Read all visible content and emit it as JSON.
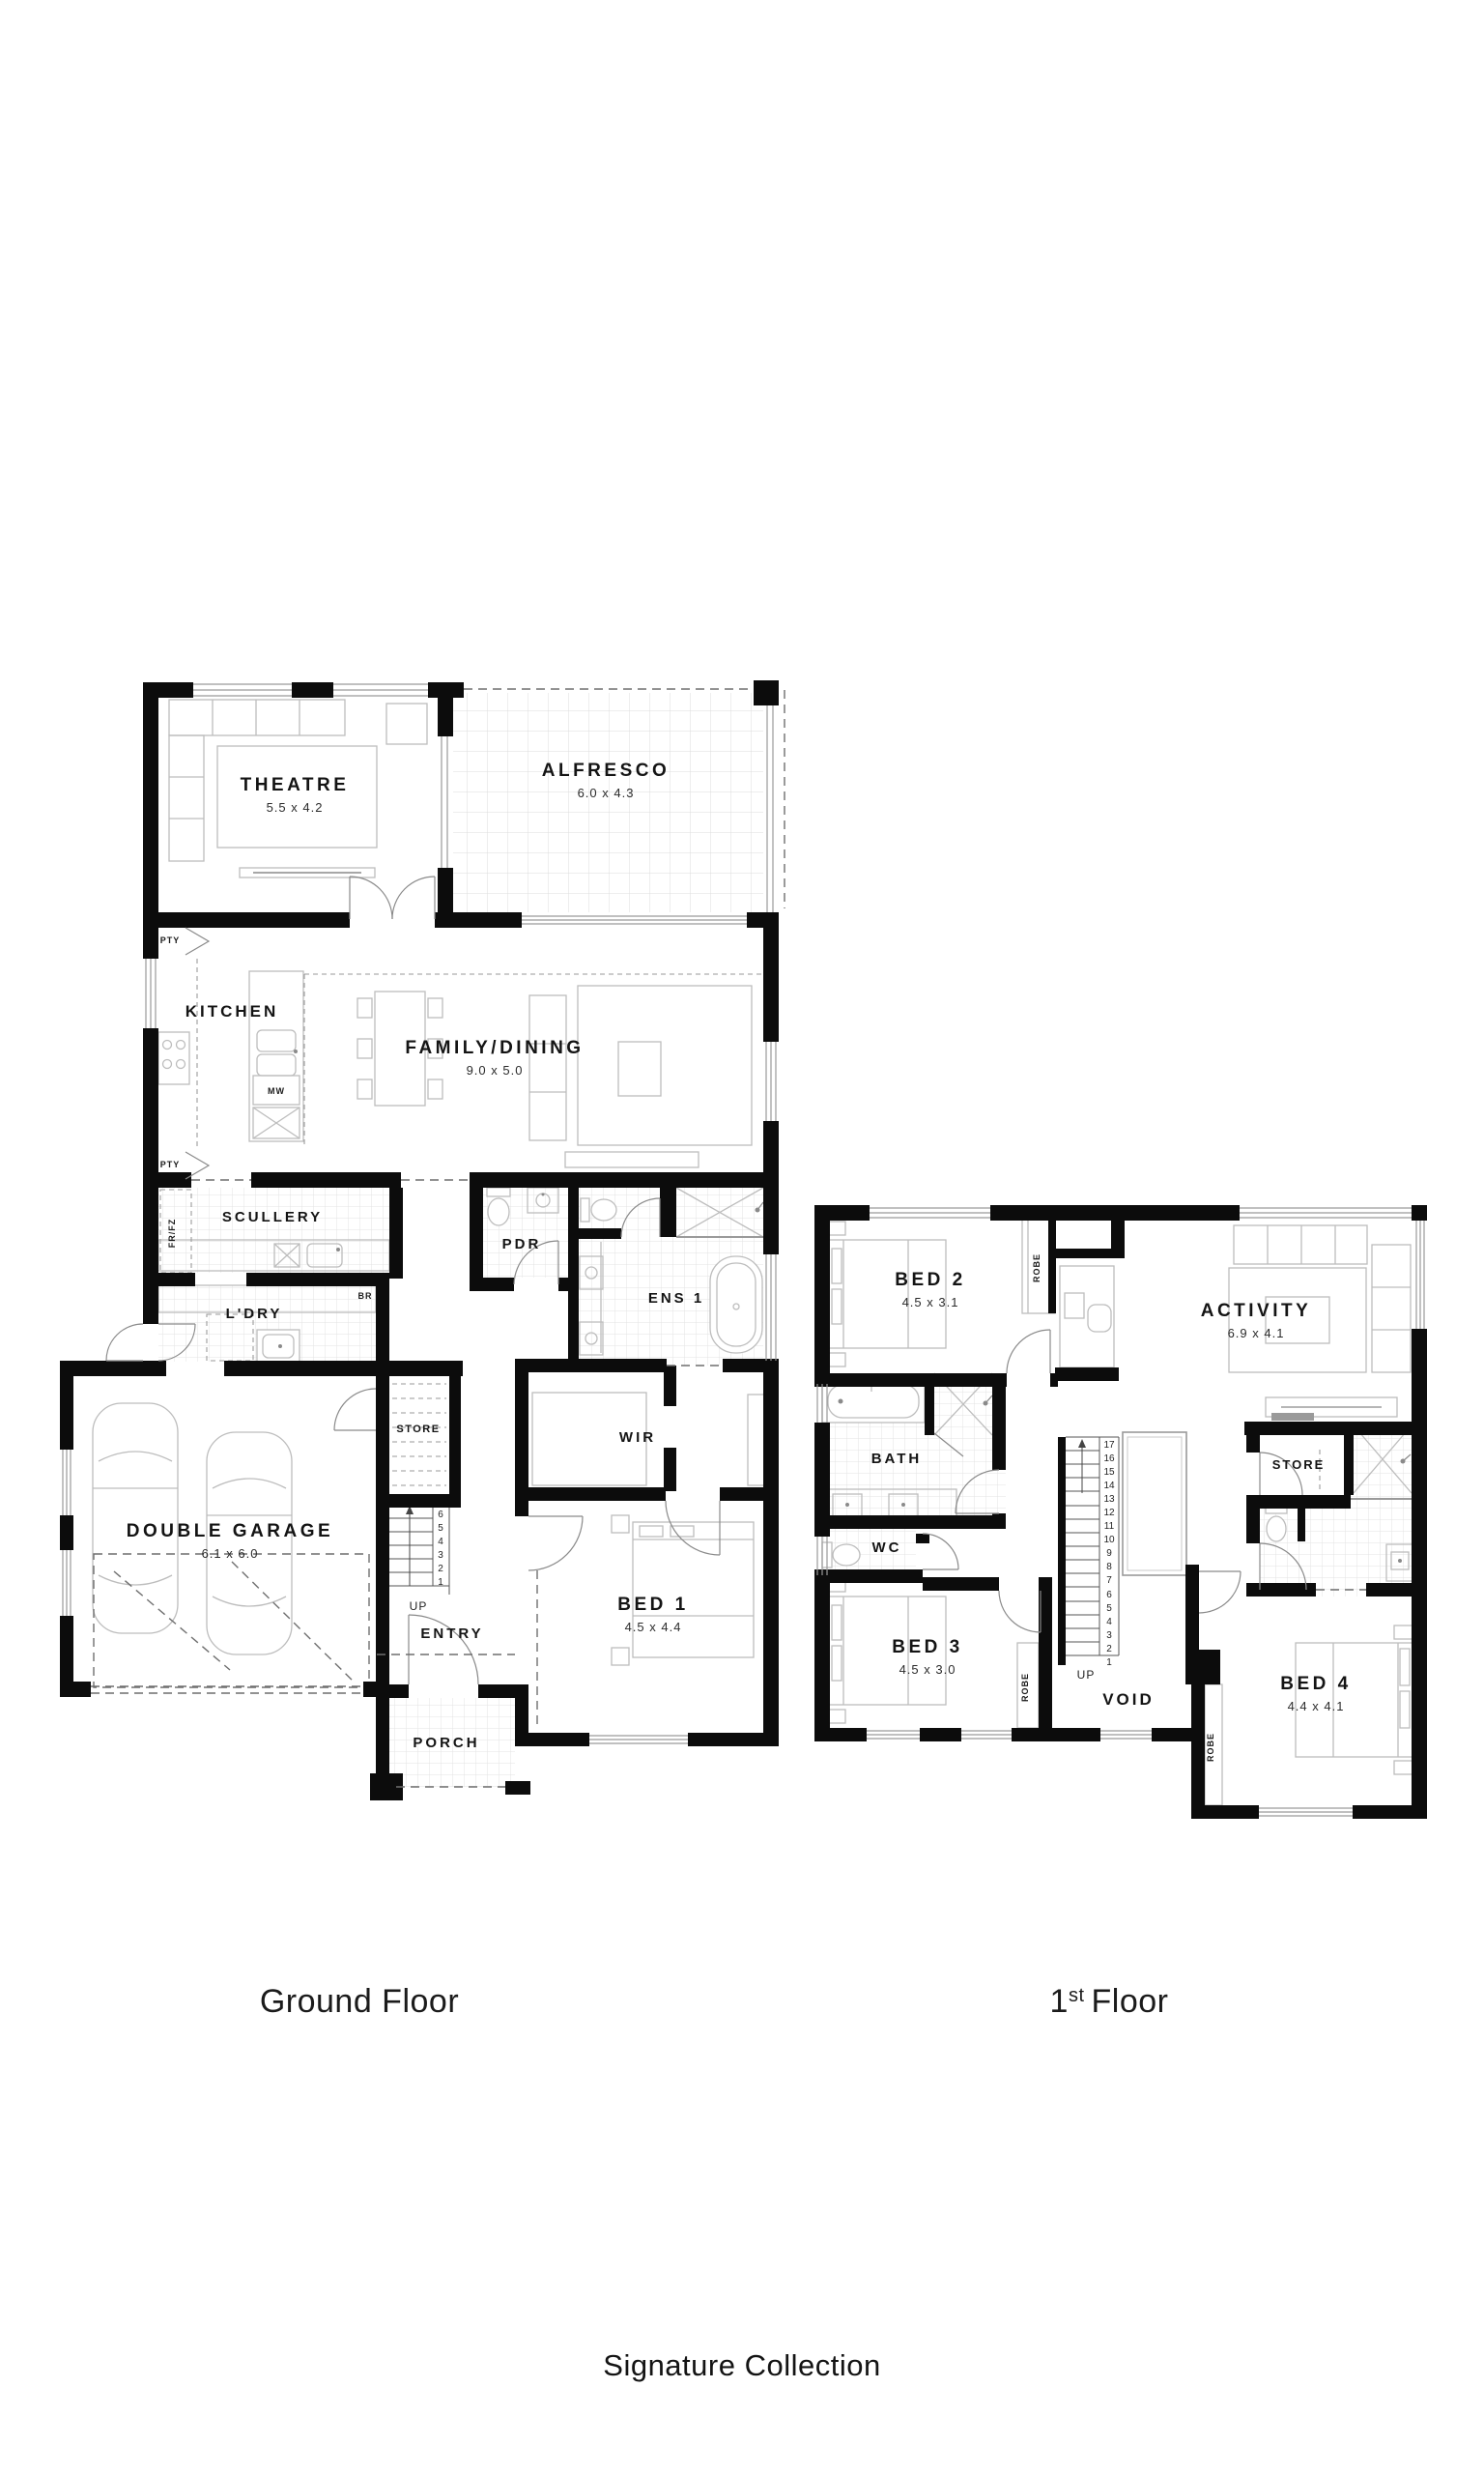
{
  "page": {
    "background": "#ffffff",
    "wall_color": "#0c0c0c"
  },
  "footer": {
    "collection_label": "Signature Collection"
  },
  "floors": {
    "ground": {
      "title": "Ground Floor",
      "up_label": "UP",
      "stair_numbers": [
        "1",
        "2",
        "3",
        "4",
        "5",
        "6"
      ],
      "rooms": {
        "theatre": {
          "name": "THEATRE",
          "dims": "5.5 x 4.2"
        },
        "alfresco": {
          "name": "ALFRESCO",
          "dims": "6.0 x 4.3"
        },
        "kitchen": {
          "name": "KITCHEN"
        },
        "family_dining": {
          "name": "FAMILY/DINING",
          "dims": "9.0 x 5.0"
        },
        "scullery": {
          "name": "SCULLERY"
        },
        "pdr": {
          "name": "PDR"
        },
        "ens1": {
          "name": "ENS 1"
        },
        "ldry": {
          "name": "L'DRY"
        },
        "wir": {
          "name": "WIR"
        },
        "double_garage": {
          "name": "DOUBLE GARAGE",
          "dims": "6.1 x 6.0"
        },
        "store": {
          "name": "STORE"
        },
        "entry": {
          "name": "ENTRY"
        },
        "bed1": {
          "name": "BED 1",
          "dims": "4.5 x 4.4"
        },
        "porch": {
          "name": "PORCH"
        }
      },
      "annotations": {
        "pty": "PTY",
        "mw": "MW",
        "frfz": "FR/FZ",
        "br": "BR"
      }
    },
    "first": {
      "title_number": "1",
      "title_suffix": "st",
      "title_word": "Floor",
      "up_label": "UP",
      "stair_numbers": [
        "1",
        "2",
        "3",
        "4",
        "5",
        "6",
        "7",
        "8",
        "9",
        "10",
        "11",
        "12",
        "13",
        "14",
        "15",
        "16",
        "17"
      ],
      "rooms": {
        "bed2": {
          "name": "BED 2",
          "dims": "4.5 x 3.1"
        },
        "activity": {
          "name": "ACTIVITY",
          "dims": "6.9 x 4.1"
        },
        "bath": {
          "name": "BATH"
        },
        "wc": {
          "name": "WC"
        },
        "store": {
          "name": "STORE"
        },
        "bed3": {
          "name": "BED 3",
          "dims": "4.5 x 3.0"
        },
        "void": {
          "name": "VOID"
        },
        "bed4": {
          "name": "BED 4",
          "dims": "4.4 x 4.1"
        }
      },
      "annotations": {
        "robe": "ROBE"
      }
    }
  }
}
